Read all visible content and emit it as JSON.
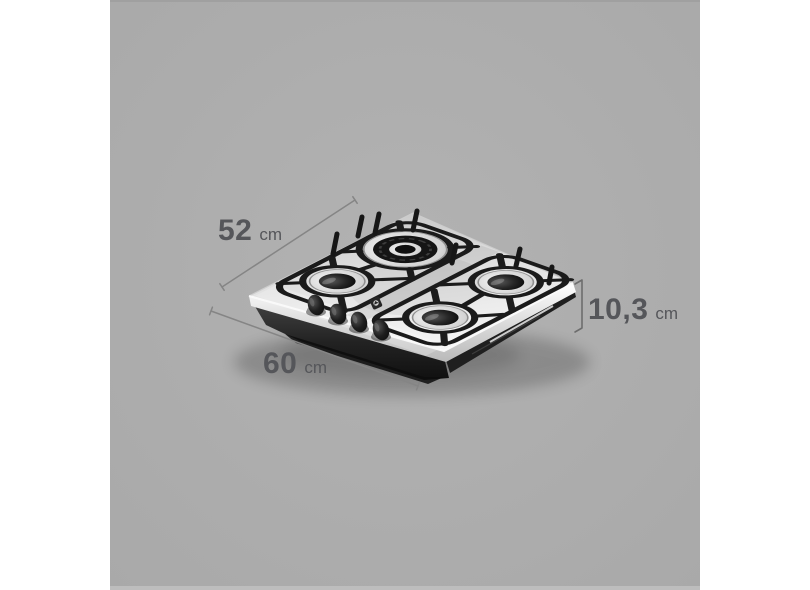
{
  "canvas": {
    "background_color": "#ffffff",
    "stage_color": "#aeaeae"
  },
  "product": {
    "name": "4-burner stainless steel gas cooktop",
    "logo_icon": "electrolux-logo",
    "burner_count": 4,
    "knob_count": 4,
    "colors": {
      "steel": "#e6e6e6",
      "grate": "#1b1b1b",
      "knob": "#141414",
      "base": "#2a2a2a"
    }
  },
  "annotations": {
    "text_color": "#55565a",
    "line_color": "#858585",
    "labels": [
      {
        "id": "depth",
        "value": "52",
        "unit": "cm"
      },
      {
        "id": "width",
        "value": "60",
        "unit": "cm"
      },
      {
        "id": "height",
        "value": "10,3",
        "unit": "cm"
      }
    ]
  }
}
